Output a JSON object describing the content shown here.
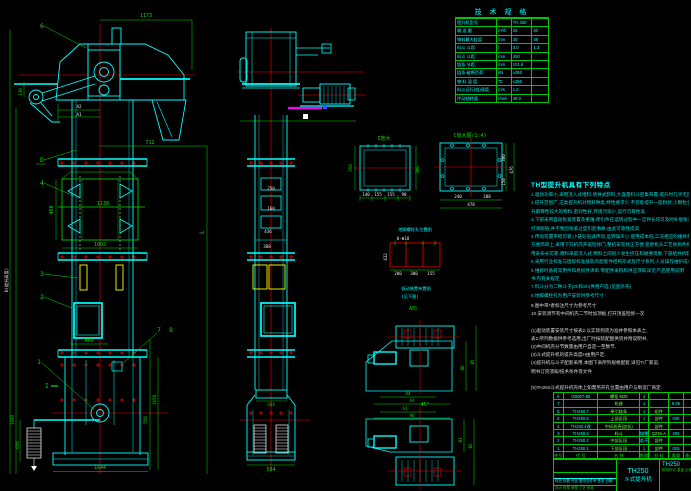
{
  "drawing": {
    "model": "TH250",
    "product": "斗式提升机"
  },
  "colors": {
    "background": "#000000",
    "line_cyan": "#00ffff",
    "line_green": "#00e000",
    "line_red": "#ff0000",
    "line_yellow": "#ffff00",
    "line_magenta": "#ff00ff",
    "text_white": "#e8e8e8"
  },
  "spec_table": {
    "title": "技 术 规 格",
    "rows": [
      {
        "l": "提升机型号",
        "u": "",
        "v1": "TH 250",
        "v2": ""
      },
      {
        "l": "输 送 量",
        "u": "m³/h",
        "v1": "25",
        "v2": "40"
      },
      {
        "l": "物料最大粒度",
        "u": "mm",
        "v1": "30",
        "v2": "48"
      },
      {
        "l": "料斗 斗容",
        "u": "l",
        "v1": "3.0",
        "v2": "1.3"
      },
      {
        "l": "料斗 斗距",
        "u": "mm",
        "v1": "450",
        "v2": ""
      },
      {
        "l": "链条 节距",
        "u": "mm",
        "v1": "101.6",
        "v2": ""
      },
      {
        "l": "链条 破断负荷",
        "u": "kN",
        "v1": "≥350",
        "v2": ""
      },
      {
        "l": "物 料 温 度",
        "u": "℃",
        "v1": "≤250",
        "v2": ""
      },
      {
        "l": "料斗运行(链)速度",
        "u": "m/s",
        "v1": "1.2",
        "v2": ""
      },
      {
        "l": "传动轴转速",
        "u": "r/min",
        "v1": "48.0",
        "v2": ""
      }
    ]
  },
  "notes": {
    "title": "TH型提升机具有下列特点",
    "lines": [
      "1.驱动功率小,采用流入式喂料,诱导式卸料,大容量料斗密集布置,提升时几乎无回料一现象",
      "2.提升范围广,这类提升机对物料种类,特性要求少,不仅能提升一般粉状,小颗粒状物料,而且可提",
      "  升磨琢性较大的物料,密封性好,环境污染少,运行可靠性高",
      "3.下部采用自动张紧装置及重锤,牵引件在运转过程中一旦伸长均可及时补偿张紧,防止",
      "  打滑脱链,并不致因张紧过度引起事故,由此可靠性提高",
      "4.传动装置平稳可靠,小链轮低速传动,运转噪声小,使用成本低,工况相应的维修费用少,安装检修",
      "  方便简单上,采用下方机壳开设检修门,整机安装找正方便,变更机头工艺易损件拆换亦方便,使",
      "  用寿命长可靠,喂料采取流入式,物料之间很少发生挤压和碰撞现象,下部给件拆卸方便",
      "5.采用行业标准与国际标准接轨的配套件结构形式及尺寸系列,人员操作维护成本低费用少,也为订",
      "6.维修时备有常用件和易损件清单,零配件采购和供应须知详见'产品使用说明",
      "  书'内有关规定",
      "7.料斗分为二种斗子(Zh和Sh)供用户选 (见图外形)",
      "8.地脚螺栓孔为用户安装时参考尺寸"
    ]
  },
  "notes2": {
    "lines": [
      "9.图中带*者标注尺寸为参考尺寸",
      "10.安装调节有中间机壳二节时加顶板,打开顶盖检修一次",
      "",
      "(1)驱动装置安装尺寸按表2,以实际到货为准并参照本表之,",
      "  表2.所列数据供参考选用,出厂时按装配图供货并附说明书,",
      "(2)中间机壳分节数量由用户自定一至数节,",
      "(3)斗式提升机的提升高度H由用户定,",
      "(4)提升机与斗子配套采用,本图下表所列规格配套,详见T/厂家说,",
      "  明书订货须知/技术条件等文件",
      "",
      "(5)TH250斗式提升机壳体上如需另开孔位置由用户与制造厂商定."
    ]
  },
  "bom": {
    "header": {
      "no": "件号",
      "code": "代 号",
      "name": "名 称",
      "qty": "数量",
      "mat": "材 料",
      "wt": "重量",
      "note": "备注"
    },
    "rows": [
      {
        "no": "8",
        "code": "GB907-86",
        "name": "螺栓 M20",
        "qty": "4",
        "mat": "",
        "wt": "",
        "note": ""
      },
      {
        "no": "7",
        "code": "",
        "name": "机座",
        "qty": "1",
        "mat": "",
        "wt": "9.05",
        "note": ""
      },
      {
        "no": "6",
        "code": "TH250.7",
        "name": "牵引链条",
        "qty": "1",
        "mat": "组件",
        "wt": "",
        "note": ""
      },
      {
        "no": "5",
        "code": "TH250.6",
        "name": "上部区段",
        "qty": "1",
        "mat": "部件",
        "wt": "035",
        "note": ""
      },
      {
        "no": "4",
        "code": "TH250.4改",
        "name": "中间机壳(加长)",
        "qty": "",
        "mat": "部件",
        "wt": "",
        "note": ""
      },
      {
        "no": "3",
        "code": "TH250.3",
        "name": "料斗",
        "qty": "按需",
        "mat": "Q235-A",
        "wt": "200",
        "note": ""
      },
      {
        "no": "2",
        "code": "TH250.2",
        "name": "中部区段",
        "qty": "若干",
        "mat": "部件",
        "wt": "",
        "note": ""
      },
      {
        "no": "1",
        "code": "TH250.1",
        "name": "下部区段",
        "qty": "1",
        "mat": "部件",
        "wt": "025",
        "note": ""
      }
    ]
  },
  "title_block": {
    "model": "TH250",
    "product": "斗式提升机",
    "dwg_no": "TH250",
    "row_labels": "标记 处数 分区 更改文件号 签名 日期",
    "roles": "设计  校核  审核  工艺  批准",
    "stage_labels": "阶段标记  重量  比例"
  },
  "front": {
    "balloons": {
      "b6": "6",
      "bd": "D",
      "b4": "4",
      "b3": "3",
      "b2": "2",
      "b1": "1",
      "b7": "7",
      "b8": "8",
      "sec": "I"
    },
    "dims": {
      "d1173": "1173",
      "a2": "A2",
      "a1": "A1",
      "d712": "712",
      "d450": "450",
      "d1130": "1130",
      "d1002": "1002",
      "d400": "400",
      "d1644": "1644",
      "d1433": "1433",
      "d650": "650",
      "d130": "130",
      "d550": "550",
      "d1650": "1650",
      "hlabel": "H(提升高度)",
      "llabel": "L"
    }
  },
  "side": {
    "dims": {
      "d250": "250",
      "d160": "160",
      "d436": "436",
      "d388": "388",
      "d344": "344",
      "d594": "594"
    }
  },
  "detail_i": {
    "label": "I放大",
    "right": "300",
    "left": "350",
    "b1": "140",
    "b2": "155",
    "b3": "155",
    "b4": "90"
  },
  "detail_c": {
    "label": "C放大图(1:4)",
    "r1": "300",
    "r2": "150",
    "r3": "476",
    "b1": "240",
    "b2": "200",
    "b3": "478"
  },
  "anchor": {
    "title": "地脚螺栓孔位置图",
    "holes": "8-Φ18",
    "left": "432",
    "b1": "200",
    "b2": "300",
    "b3": "155",
    "cap1": "驱动装置布置图",
    "cap2": "(见下图)",
    "view": "A向"
  },
  "drive": {
    "angle": "45°",
    "a4": "A4",
    "a3": "A3",
    "b6": "B6",
    "b5": "B5",
    "a1": "A1",
    "a6": "A6",
    "b1": "B1",
    "b2": "B2"
  }
}
